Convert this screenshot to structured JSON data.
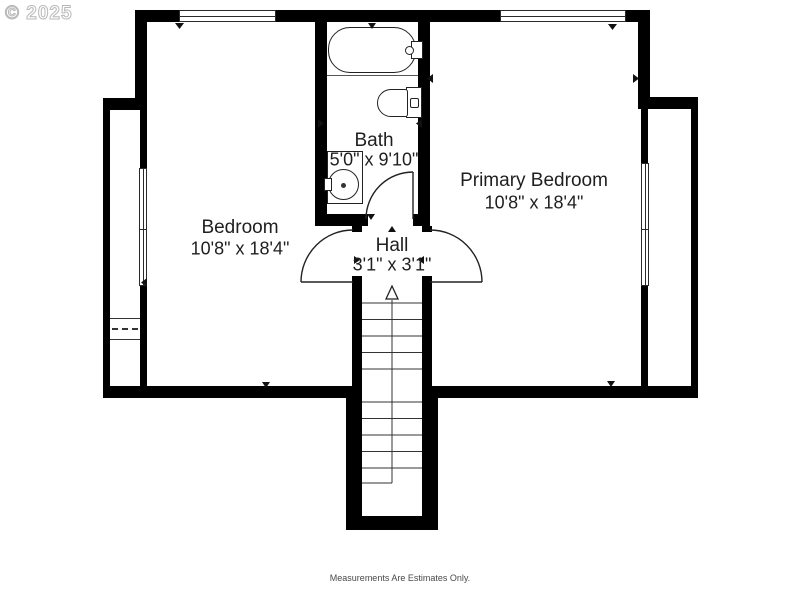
{
  "watermark": "© 2025",
  "disclaimer": "Measurements Are Estimates Only.",
  "rooms": {
    "bedroom": {
      "name": "Bedroom",
      "dims": "10'8\" x 18'4\""
    },
    "bath": {
      "name": "Bath",
      "dims": "5'0\" x 9'10\""
    },
    "hall": {
      "name": "Hall",
      "dims": "3'1\" x 3'1\""
    },
    "primary": {
      "name": "Primary Bedroom",
      "dims": "10'8\" x 18'4\""
    }
  },
  "symbols": {
    "fixtures": [
      "bathtub",
      "toilet",
      "sink-vanity",
      "shelf"
    ],
    "doors": [
      "bath-door",
      "bedroom-door",
      "primary-bedroom-door"
    ],
    "windows": [
      "top-left-window",
      "top-right-window",
      "left-side-window",
      "right-side-window"
    ],
    "stairs": "staircase-up-arrow"
  },
  "colors": {
    "wall": "#000000",
    "background": "#ffffff",
    "label_text": "#1f1f1f",
    "fixture_line": "#2a2a2a",
    "watermark": "#b8b8b8",
    "disclaimer": "#4a4a4a"
  }
}
